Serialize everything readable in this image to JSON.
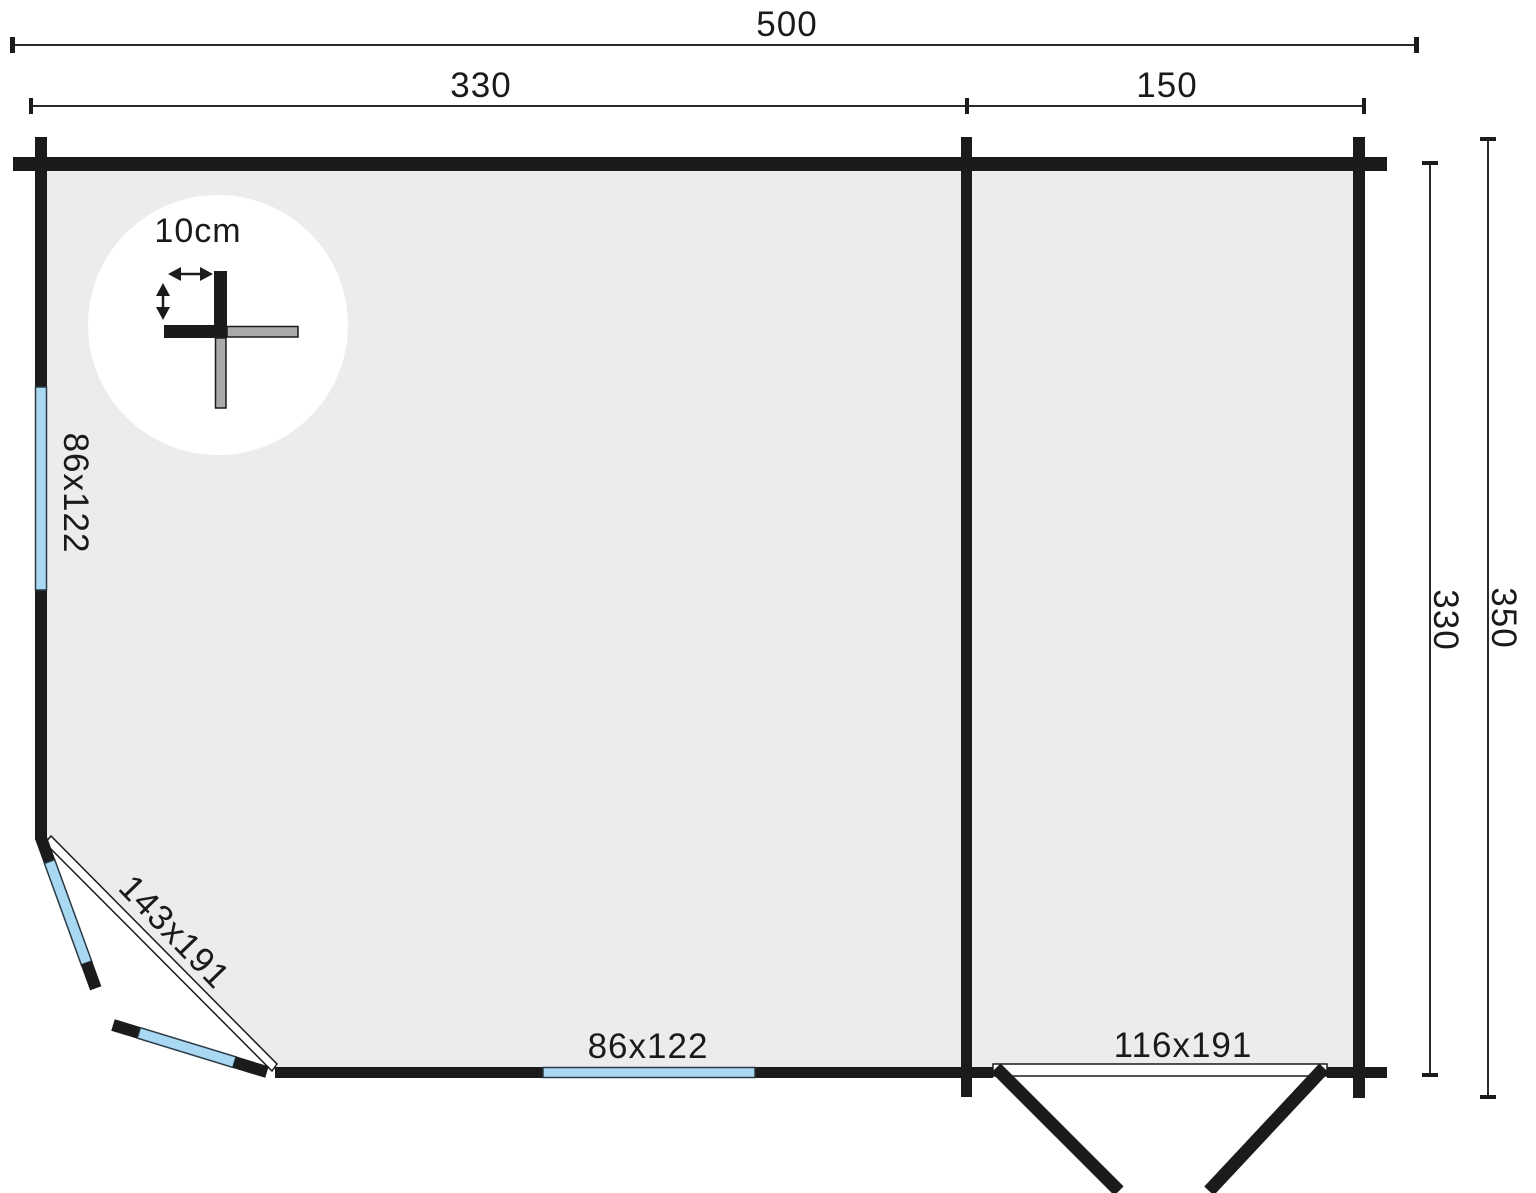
{
  "plan": {
    "dims": {
      "total_width": "500",
      "front_left": "330",
      "front_right": "150",
      "depth_inner": "330",
      "depth_outer": "350"
    },
    "detail": {
      "wall_thickness": "10cm"
    },
    "openings": {
      "left_window": "86x122",
      "corner_door": "143x191",
      "front_window": "86x122",
      "double_door": "116x191"
    },
    "colors": {
      "wall": "#1b1b1b",
      "floor": "#ececee",
      "glass": "#a9d8f2",
      "log_gray": "#a9a9a9",
      "background": "#ffffff"
    }
  }
}
